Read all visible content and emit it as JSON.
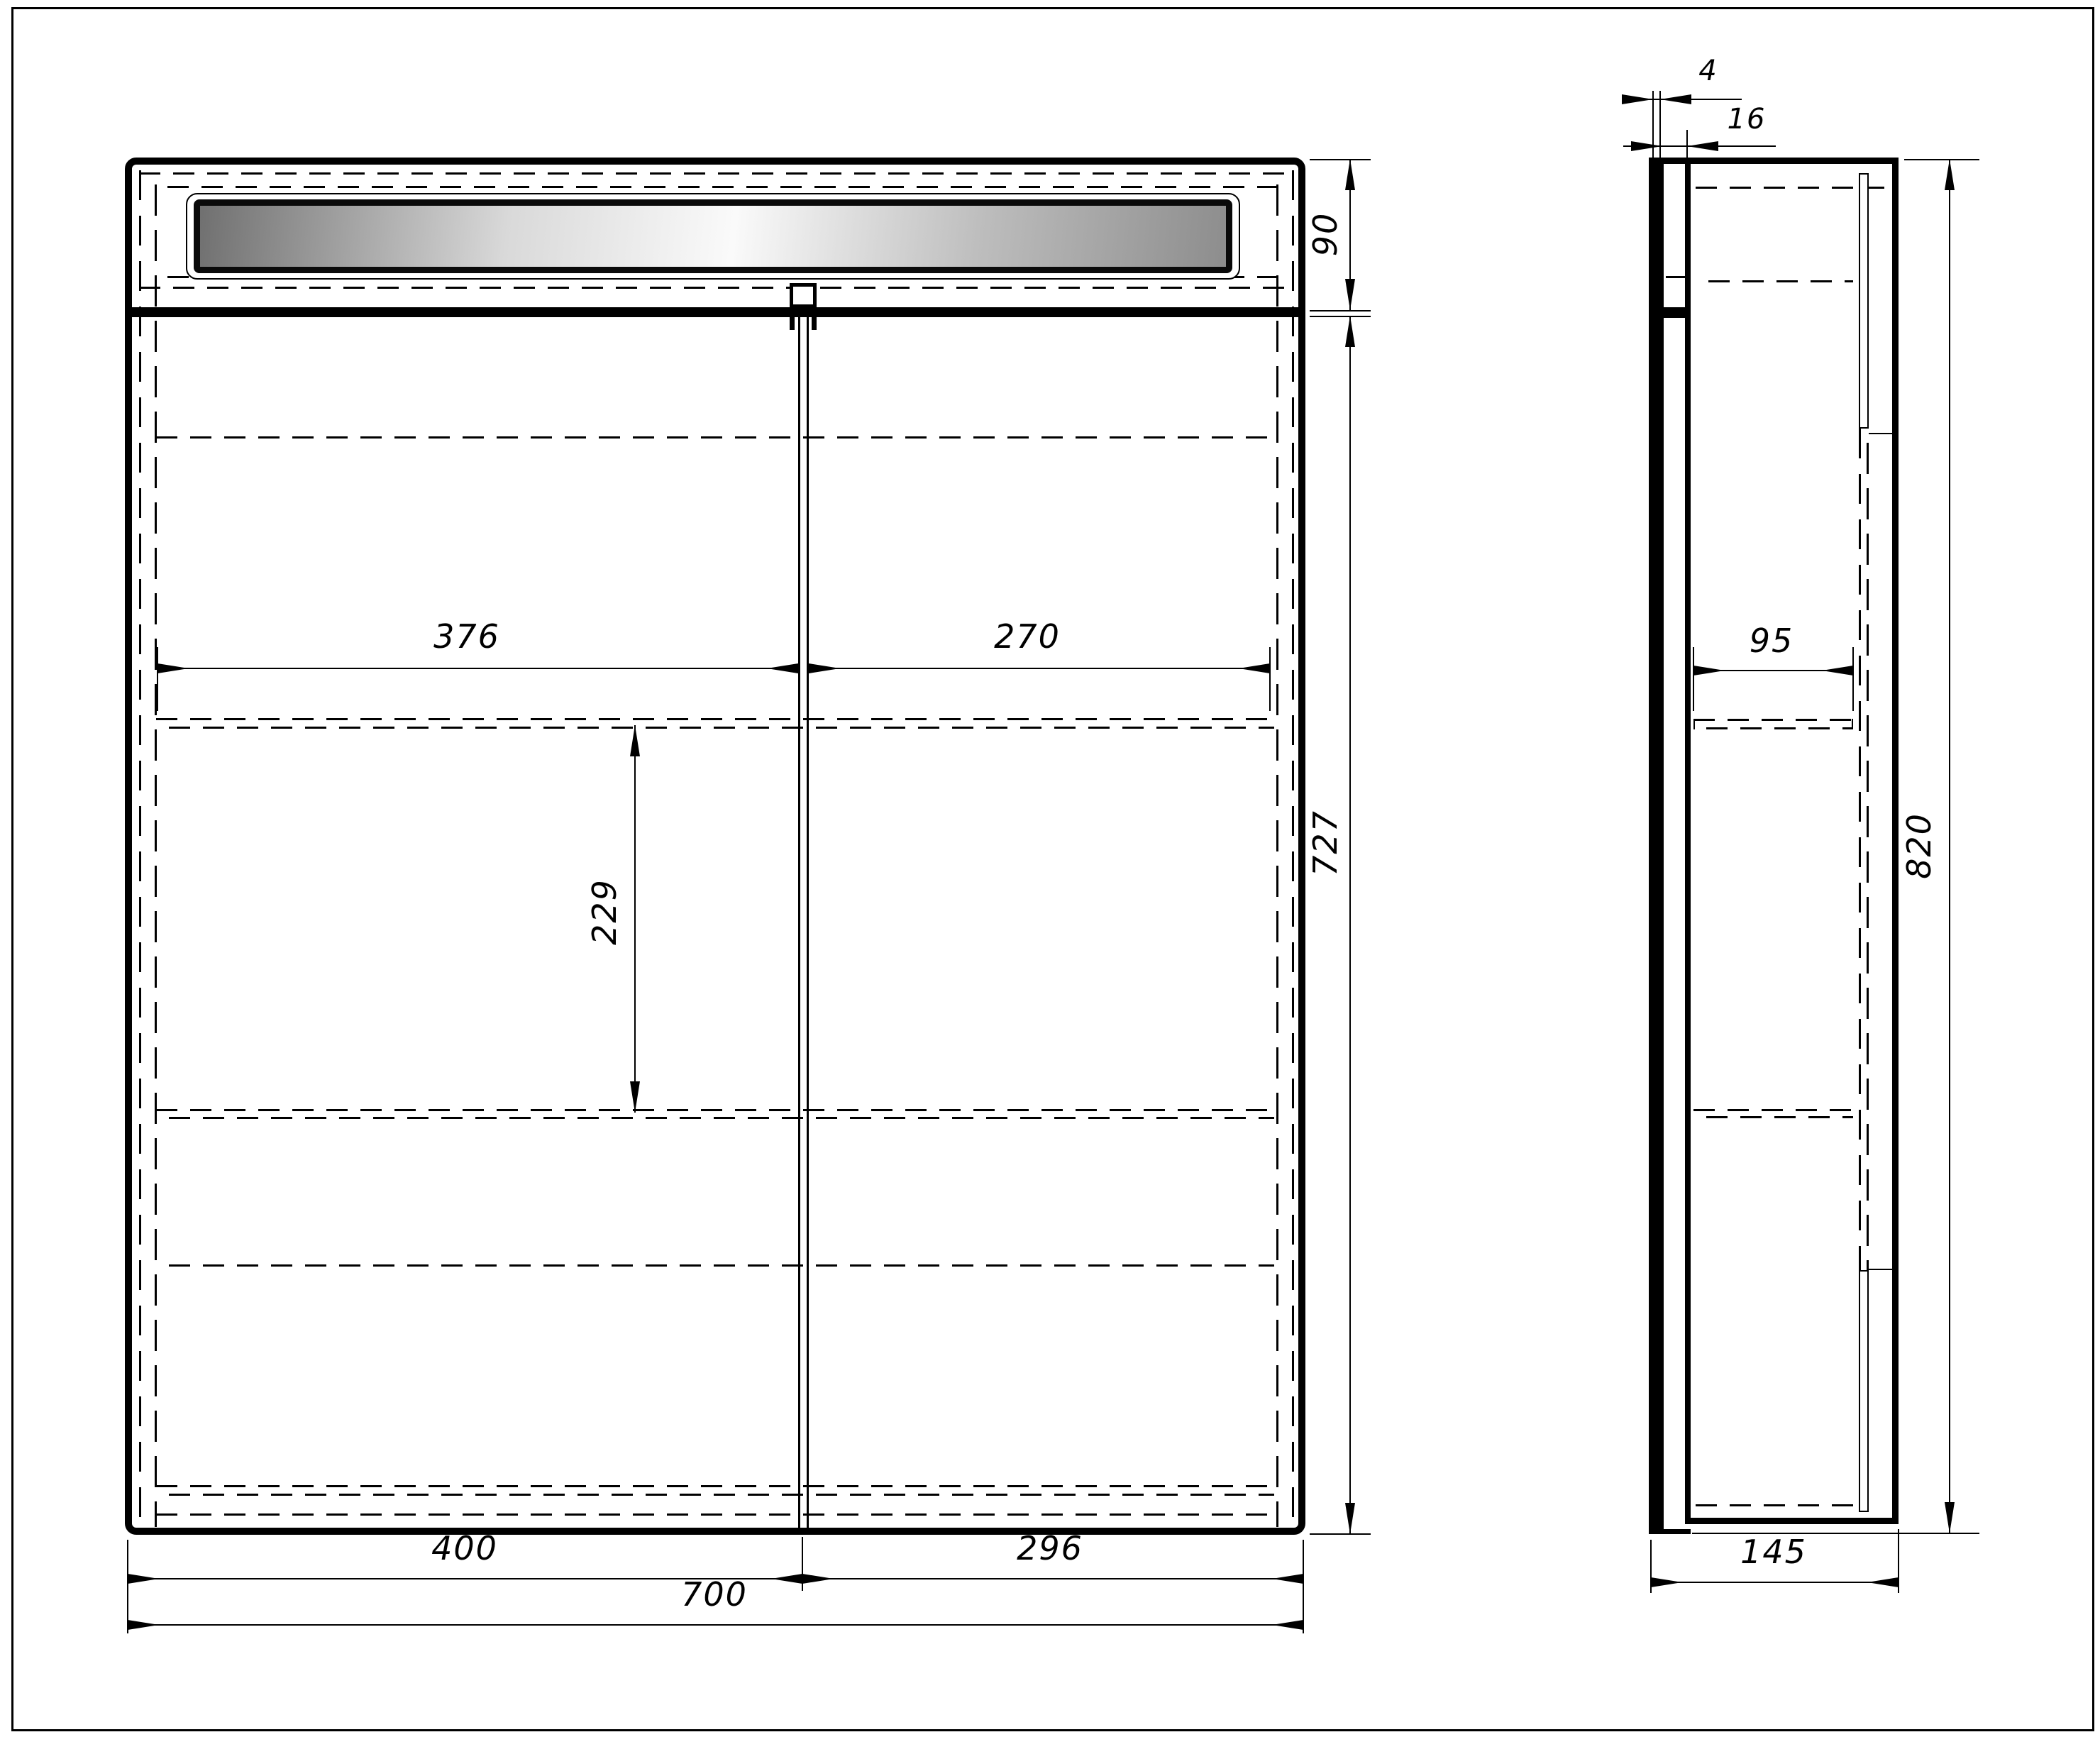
{
  "front_view": {
    "top_section_height": "90",
    "body_height": "727",
    "inner_width_left": "376",
    "inner_width_right": "270",
    "shelf_spacing": "229",
    "door_left_width": "400",
    "door_right_width": "296",
    "total_width": "700"
  },
  "side_view": {
    "mirror_thickness": "4",
    "door_thickness": "16",
    "shelf_depth": "95",
    "total_height": "820",
    "total_depth": "145"
  },
  "colors": {
    "line": "#000000",
    "background": "#ffffff",
    "led_dark": "#707070",
    "led_light": "#fafafa"
  }
}
